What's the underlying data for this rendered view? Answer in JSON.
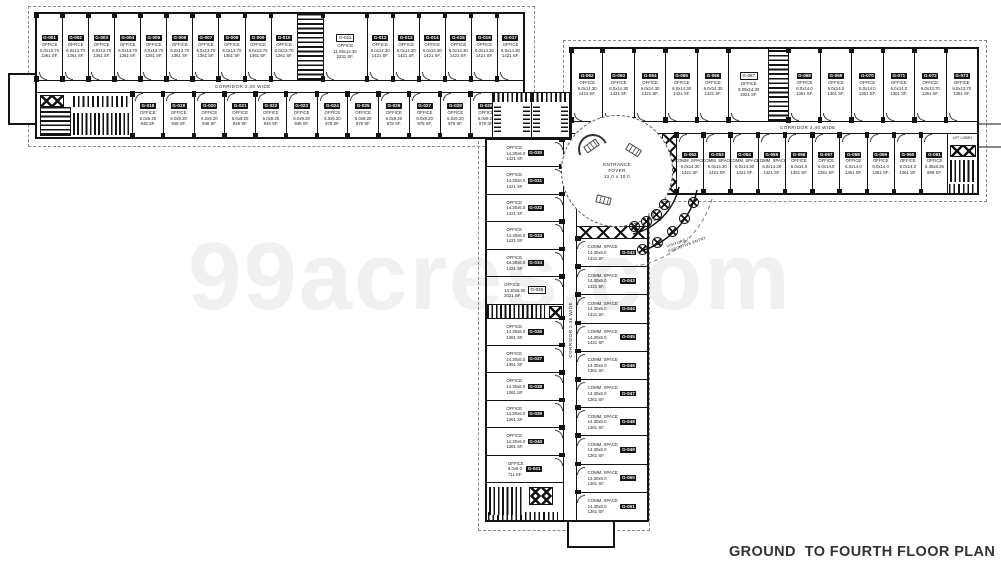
{
  "labels": {
    "title": "GROUND  TO FOURTH FLOOR PLAN",
    "watermark": "99acres.com",
    "corridor_top": "CORRIDOR 2.00 WIDE",
    "corridor_right": "CORRIDOR 2.40 WIDE",
    "corridor_vertical": "CORRIDOR 2.35 WIDE",
    "foyer_line1": "ENTRANCE",
    "foyer_line2": "FOYER",
    "foyer_line3": "12.0 x 10.0",
    "ent_lobby": "ENT. LOBBY",
    "visitors_entry": "VISITORS / EXECUTIVE ENTRY",
    "lift_lobby": "LIFT LOBBY"
  },
  "colors": {
    "wall": "#141414",
    "dashed_boundary": "#8a8a8a",
    "watermark": "#f0f0f0",
    "title": "#333333"
  },
  "top_wing": {
    "top_row": [
      {
        "no": "G-001",
        "type": "OFFICE",
        "dims": "6.0x13.70",
        "area": "1361 SF."
      },
      {
        "no": "G-002",
        "type": "OFFICE",
        "dims": "6.0x13.70",
        "area": "1361 SF."
      },
      {
        "no": "G-003",
        "type": "OFFICE",
        "dims": "6.0x13.70",
        "area": "1361 SF."
      },
      {
        "no": "G-004",
        "type": "OFFICE",
        "dims": "6.0x13.70",
        "area": "1361 SF."
      },
      {
        "no": "G-005",
        "type": "OFFICE",
        "dims": "6.0x13.70",
        "area": "1361 SF."
      },
      {
        "no": "G-006",
        "type": "OFFICE",
        "dims": "6.0x13.70",
        "area": "1361 SF."
      },
      {
        "no": "G-007",
        "type": "OFFICE",
        "dims": "6.0x13.70",
        "area": "1361 SF."
      },
      {
        "no": "G-008",
        "type": "OFFICE",
        "dims": "6.0x13.70",
        "area": "1361 SF."
      },
      {
        "no": "G-009",
        "type": "OFFICE",
        "dims": "6.0x13.70",
        "area": "1361 SF."
      },
      {
        "no": "G-010",
        "type": "OFFICE",
        "dims": "6.0x13.70",
        "area": "1361 SF."
      },
      {
        "util": "stair",
        "w": 26
      },
      {
        "no": "G-011",
        "type": "OFFICE",
        "dims": "11.95x14.30",
        "area": "2231 SF.",
        "badge": "outline",
        "w": 44
      },
      {
        "no": "G-012",
        "type": "OFFICE",
        "dims": "6.0x14.30",
        "area": "1421 SF."
      },
      {
        "no": "G-013",
        "type": "OFFICE",
        "dims": "6.0x14.30",
        "area": "1421 SF."
      },
      {
        "no": "G-014",
        "type": "OFFICE",
        "dims": "6.0x14.30",
        "area": "1421 SF."
      },
      {
        "no": "G-015",
        "type": "OFFICE",
        "dims": "6.0x14.30",
        "area": "1421 SF."
      },
      {
        "no": "G-016",
        "type": "OFFICE",
        "dims": "6.0x14.30",
        "area": "1421 SF."
      },
      {
        "no": "G-017",
        "type": "OFFICE",
        "dims": "6.0x14.30",
        "area": "1421 SF."
      }
    ],
    "bottom_row": [
      {
        "util": "lobby",
        "w": 95
      },
      {
        "no": "G-018",
        "type": "OFFICE",
        "dims": "6.0x9.20",
        "area": "948 SF."
      },
      {
        "no": "G-019",
        "type": "OFFICE",
        "dims": "6.0x9.20",
        "area": "948 SF."
      },
      {
        "no": "G-020",
        "type": "OFFICE",
        "dims": "6.0x9.20",
        "area": "948 SF."
      },
      {
        "no": "G-021",
        "type": "OFFICE",
        "dims": "6.0x9.20",
        "area": "948 SF."
      },
      {
        "no": "G-022",
        "type": "OFFICE",
        "dims": "6.0x9.20",
        "area": "948 SF."
      },
      {
        "no": "G-023",
        "type": "OFFICE",
        "dims": "6.0x9.20",
        "area": "948 SF."
      },
      {
        "no": "G-024",
        "type": "OFFICE",
        "dims": "6.0x9.20",
        "area": "978 SF."
      },
      {
        "no": "G-025",
        "type": "OFFICE",
        "dims": "6.0x9.20",
        "area": "978 SF."
      },
      {
        "no": "G-026",
        "type": "OFFICE",
        "dims": "6.0x9.20",
        "area": "978 SF."
      },
      {
        "no": "G-027",
        "type": "OFFICE",
        "dims": "6.0x9.20",
        "area": "978 SF."
      },
      {
        "no": "G-028",
        "type": "OFFICE",
        "dims": "6.0x9.20",
        "area": "978 SF."
      },
      {
        "no": "G-029",
        "type": "OFFICE",
        "dims": "6.0x9.20",
        "area": "978 SF."
      },
      {
        "util": "stair",
        "w": 22
      }
    ]
  },
  "right_wing": {
    "top_row": [
      {
        "no": "G-062",
        "type": "OFFICE",
        "dims": "6.0x14.30",
        "area": "1421 SF."
      },
      {
        "no": "G-063",
        "type": "OFFICE",
        "dims": "6.0x14.30",
        "area": "1421 SF."
      },
      {
        "no": "G-064",
        "type": "OFFICE",
        "dims": "6.0x14.30",
        "area": "1421 SF."
      },
      {
        "no": "G-065",
        "type": "OFFICE",
        "dims": "6.0x14.30",
        "area": "1421 SF."
      },
      {
        "no": "G-066",
        "type": "OFFICE",
        "dims": "6.0x14.30",
        "area": "1421 SF."
      },
      {
        "no": "G-067",
        "type": "OFFICE",
        "dims": "8.05x14.30",
        "area": "2021 SF.",
        "badge": "outline",
        "w": 40
      },
      {
        "util": "stair",
        "w": 20
      },
      {
        "no": "G-068",
        "type": "OFFICE",
        "dims": "6.0x14.0",
        "area": "1361 SF."
      },
      {
        "no": "G-069",
        "type": "OFFICE",
        "dims": "6.0x14.0",
        "area": "1361 SF."
      },
      {
        "no": "G-070",
        "type": "OFFICE",
        "dims": "6.0x14.0",
        "area": "1361 SF."
      },
      {
        "no": "G-071",
        "type": "OFFICE",
        "dims": "6.0x14.0",
        "area": "1361 SF."
      },
      {
        "no": "G-072",
        "type": "OFFICE",
        "dims": "6.0x13.70",
        "area": "1361 SF."
      },
      {
        "no": "G-073",
        "type": "OFFICE",
        "dims": "6.0x13.70",
        "area": "1361 SF."
      }
    ],
    "bottom_row": [
      {
        "util": "gap",
        "w": 90
      },
      {
        "util": "xgridV",
        "w": 14
      },
      {
        "no": "G-052",
        "type": "COMM. SPACE",
        "dims": "6.0x14.30",
        "area": "1421 SF."
      },
      {
        "no": "G-053",
        "type": "COMM. SPACE",
        "dims": "6.0x14.30",
        "area": "1421 SF."
      },
      {
        "no": "G-054",
        "type": "COMM. SPACE",
        "dims": "6.0x14.30",
        "area": "1421 SF."
      },
      {
        "no": "G-055",
        "type": "COMM. SPACE",
        "dims": "6.0x14.30",
        "area": "1421 SF."
      },
      {
        "no": "G-056",
        "type": "OFFICE",
        "dims": "6.0x14.0",
        "area": "1361 SF."
      },
      {
        "no": "G-057",
        "type": "OFFICE",
        "dims": "6.0x14.0",
        "area": "1361 SF."
      },
      {
        "no": "G-058",
        "type": "OFFICE",
        "dims": "6.0x14.0",
        "area": "1361 SF."
      },
      {
        "no": "G-059",
        "type": "OFFICE",
        "dims": "6.0x14.0",
        "area": "1361 SF."
      },
      {
        "no": "G-060",
        "type": "OFFICE",
        "dims": "6.0x14.0",
        "area": "1361 SF."
      },
      {
        "no": "G-061",
        "type": "OFFICE",
        "dims": "6.35x8.25",
        "area": "698 SF.",
        "w": 26
      },
      {
        "util": "end",
        "w": 30,
        "label": "LIFT LOBBY"
      }
    ]
  },
  "vertical_wing": {
    "left_col": [
      {
        "no": "G-030",
        "type": "OFFICE",
        "dims": "14.30x6.0",
        "area": "1421 SF."
      },
      {
        "no": "G-031",
        "type": "OFFICE",
        "dims": "14.30x6.0",
        "area": "1421 SF."
      },
      {
        "no": "G-032",
        "type": "OFFICE",
        "dims": "14.30x6.0",
        "area": "1421 SF."
      },
      {
        "no": "G-033",
        "type": "OFFICE",
        "dims": "14.30x6.0",
        "area": "1421 SF."
      },
      {
        "no": "G-034",
        "type": "OFFICE",
        "dims": "14.30x6.0",
        "area": "1421 SF."
      },
      {
        "no": "G-035",
        "type": "OFFICE",
        "dims": "14.30x8.05",
        "area": "2021 SF.",
        "badge": "outline"
      },
      {
        "util": "ustrip",
        "h": 14
      },
      {
        "no": "G-036",
        "type": "OFFICE",
        "dims": "14.30x6.0",
        "area": "1361 SF."
      },
      {
        "no": "G-037",
        "type": "OFFICE",
        "dims": "14.30x6.0",
        "area": "1361 SF."
      },
      {
        "no": "G-038",
        "type": "OFFICE",
        "dims": "14.30x6.0",
        "area": "1361 SF."
      },
      {
        "no": "G-039",
        "type": "OFFICE",
        "dims": "14.30x6.0",
        "area": "1361 SF."
      },
      {
        "no": "G-040",
        "type": "OFFICE",
        "dims": "14.30x6.0",
        "area": "1361 SF."
      },
      {
        "no": "G-041",
        "type": "OFFICE",
        "dims": "8.0x6.0",
        "area": "711 SF."
      },
      {
        "util": "vbottom",
        "h": 38
      }
    ],
    "right_col": [
      {
        "util": "gap",
        "h": 86
      },
      {
        "util": "xgrid",
        "h": 12
      },
      {
        "no": "G-042",
        "type": "COMM. SPACE",
        "dims": "14.30x6.0",
        "area": "1421 SF."
      },
      {
        "no": "G-043",
        "type": "COMM. SPACE",
        "dims": "14.30x6.0",
        "area": "1421 SF."
      },
      {
        "no": "G-044",
        "type": "COMM. SPACE",
        "dims": "14.30x6.0",
        "area": "1421 SF."
      },
      {
        "no": "G-045",
        "type": "COMM. SPACE",
        "dims": "14.30x6.0",
        "area": "1421 SF."
      },
      {
        "no": "G-046",
        "type": "COMM. SPACE",
        "dims": "14.30x6.0",
        "area": "1361 SF."
      },
      {
        "no": "G-047",
        "type": "COMM. SPACE",
        "dims": "14.30x6.0",
        "area": "1361 SF."
      },
      {
        "no": "G-048",
        "type": "COMM. SPACE",
        "dims": "14.30x6.0",
        "area": "1361 SF."
      },
      {
        "no": "G-049",
        "type": "COMM. SPACE",
        "dims": "14.30x6.0",
        "area": "1361 SF."
      },
      {
        "no": "G-050",
        "type": "COMM. SPACE",
        "dims": "14.30x6.0",
        "area": "1361 SF."
      },
      {
        "no": "G-051",
        "type": "COMM. SPACE",
        "dims": "14.30x6.0",
        "area": "1361 SF."
      }
    ]
  },
  "entry_columns": {
    "inner_arc": [
      [
        659,
        199
      ],
      [
        651,
        209
      ],
      [
        641,
        216
      ],
      [
        629,
        221
      ]
    ],
    "outer_arc": [
      [
        688,
        197
      ],
      [
        679,
        213
      ],
      [
        667,
        226
      ],
      [
        652,
        237
      ],
      [
        637,
        244
      ]
    ]
  }
}
